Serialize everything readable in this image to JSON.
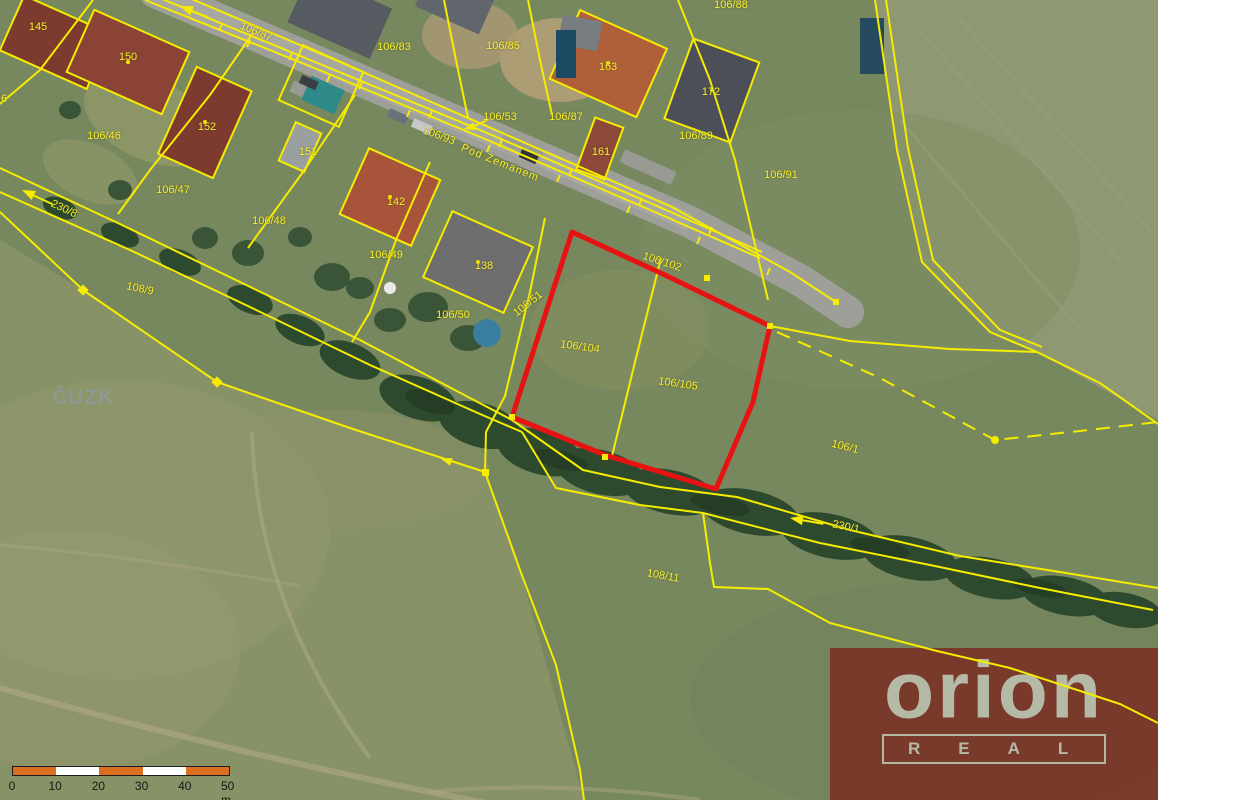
{
  "map": {
    "watermark": "ČUZK",
    "highlighted_parcels": [
      "106/104",
      "106/105"
    ],
    "colors": {
      "boundary_yellow": "#f6ec00",
      "highlight_red": "#e81212",
      "label_yellow": "#f8ee2a",
      "watermark_grey": "#8e9a98",
      "field_green": "#78885e",
      "road_grey": "#9f9f99"
    },
    "labels": [
      {
        "t": "145",
        "x": 38,
        "y": 27,
        "r": 0
      },
      {
        "t": "150",
        "x": 128,
        "y": 57,
        "r": 0
      },
      {
        "t": "106/87",
        "x": 256,
        "y": 32,
        "r": 22
      },
      {
        "t": "152",
        "x": 207,
        "y": 127,
        "r": 0
      },
      {
        "t": "106/46",
        "x": 104,
        "y": 136,
        "r": 0
      },
      {
        "t": "6",
        "x": 4,
        "y": 99,
        "r": 0
      },
      {
        "t": "151",
        "x": 308,
        "y": 152,
        "r": 0
      },
      {
        "t": "106/83",
        "x": 394,
        "y": 47,
        "r": 0
      },
      {
        "t": "106/85",
        "x": 503,
        "y": 46,
        "r": 0
      },
      {
        "t": "106/87",
        "x": 566,
        "y": 117,
        "r": 0
      },
      {
        "t": "163",
        "x": 608,
        "y": 67,
        "r": 0
      },
      {
        "t": "161",
        "x": 601,
        "y": 152,
        "r": 0
      },
      {
        "t": "172",
        "x": 711,
        "y": 92,
        "r": 0
      },
      {
        "t": "106/88",
        "x": 731,
        "y": 5,
        "r": 0
      },
      {
        "t": "106/89",
        "x": 696,
        "y": 136,
        "r": 0
      },
      {
        "t": "106/91",
        "x": 781,
        "y": 175,
        "r": 0
      },
      {
        "t": "106/47",
        "x": 173,
        "y": 190,
        "r": 0
      },
      {
        "t": "106/48",
        "x": 269,
        "y": 221,
        "r": 0
      },
      {
        "t": "230/8",
        "x": 64,
        "y": 209,
        "r": 25
      },
      {
        "t": "106/93",
        "x": 439,
        "y": 136,
        "r": 20
      },
      {
        "t": "Pod Zemanem",
        "x": 500,
        "y": 163,
        "r": 22,
        "k": "street"
      },
      {
        "t": "142",
        "x": 396,
        "y": 202,
        "r": 0
      },
      {
        "t": "106/49",
        "x": 386,
        "y": 255,
        "r": 0
      },
      {
        "t": "138",
        "x": 484,
        "y": 266,
        "r": 0
      },
      {
        "t": "106/50",
        "x": 453,
        "y": 315,
        "r": 0
      },
      {
        "t": "106/51",
        "x": 528,
        "y": 304,
        "r": -38
      },
      {
        "t": "106/53",
        "x": 500,
        "y": 117,
        "r": 0
      },
      {
        "t": "108/9",
        "x": 140,
        "y": 289,
        "r": 12
      },
      {
        "t": "106/102",
        "x": 662,
        "y": 262,
        "r": 18
      },
      {
        "t": "106/104",
        "x": 580,
        "y": 347,
        "r": 8
      },
      {
        "t": "106/105",
        "x": 678,
        "y": 384,
        "r": 8
      },
      {
        "t": "106/1",
        "x": 845,
        "y": 447,
        "r": 14
      },
      {
        "t": "230/1",
        "x": 846,
        "y": 527,
        "r": 12
      },
      {
        "t": "108/11",
        "x": 663,
        "y": 576,
        "r": 10
      }
    ]
  },
  "scalebar": {
    "labels": [
      "0",
      "10",
      "20",
      "30",
      "40",
      "50 m"
    ],
    "bar_colors": [
      "#d96f1f",
      "#ffffff",
      "#d96f1f",
      "#ffffff",
      "#d96f1f"
    ],
    "border_color": "#1c1c1c",
    "text_color": "#161616"
  },
  "logo": {
    "brand": "orion",
    "word": "REAL",
    "bg": "#7a2c21",
    "fg": "#b9c3ae"
  }
}
